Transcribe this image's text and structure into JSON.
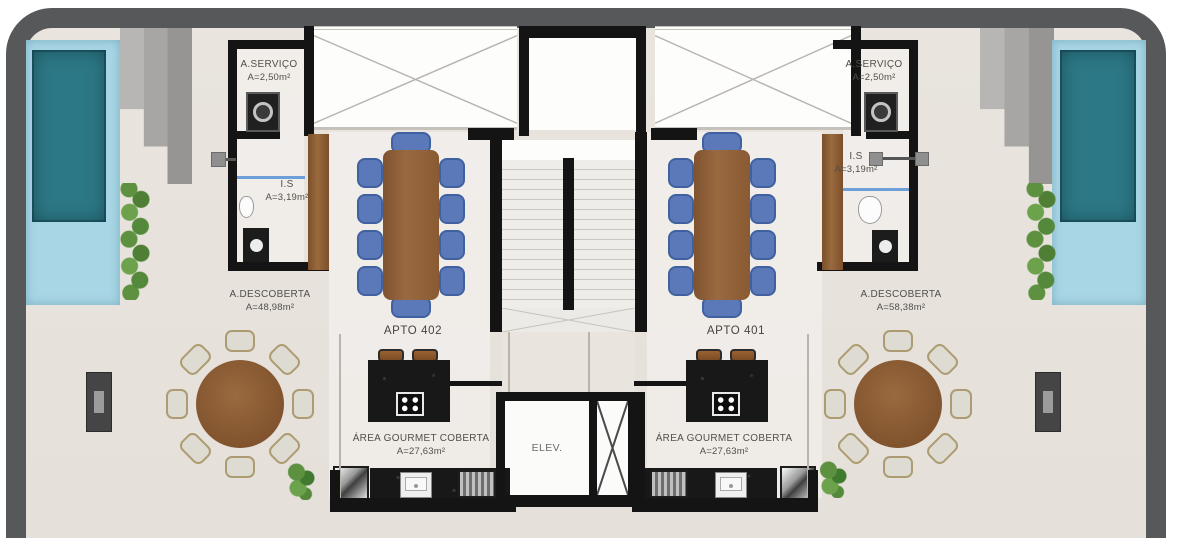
{
  "colors": {
    "frame": "#57585a",
    "wall": "#141414",
    "floor": "#e7e2dc",
    "pool_water": "#2d7886",
    "pool_tile": "#a9d6e5",
    "hedge_green": "#5d9140",
    "chair_blue": "#5b79b8",
    "table_wood": "#8a5a33"
  },
  "units": [
    {
      "label": "APTO 402",
      "service": {
        "name": "A.SERVIÇO",
        "area": "A=2,50m²"
      },
      "bathroom": {
        "name": "I.S",
        "area": "A=3,19m²"
      },
      "terrace": {
        "name": "A.DESCOBERTA",
        "area": "A=48,98m²"
      },
      "gourmet": {
        "name": "ÁREA GOURMET COBERTA",
        "area": "A=27,63m²"
      }
    },
    {
      "label": "APTO 401",
      "service": {
        "name": "A.SERVIÇO",
        "area": "A=2,50m²"
      },
      "bathroom": {
        "name": "I.S",
        "area": "A=3,19m²"
      },
      "terrace": {
        "name": "A.DESCOBERTA",
        "area": "A=58,38m²"
      },
      "gourmet": {
        "name": "ÁREA GOURMET COBERTA",
        "area": "A=27,63m²"
      }
    }
  ],
  "core": {
    "elevator": "ELEV."
  }
}
